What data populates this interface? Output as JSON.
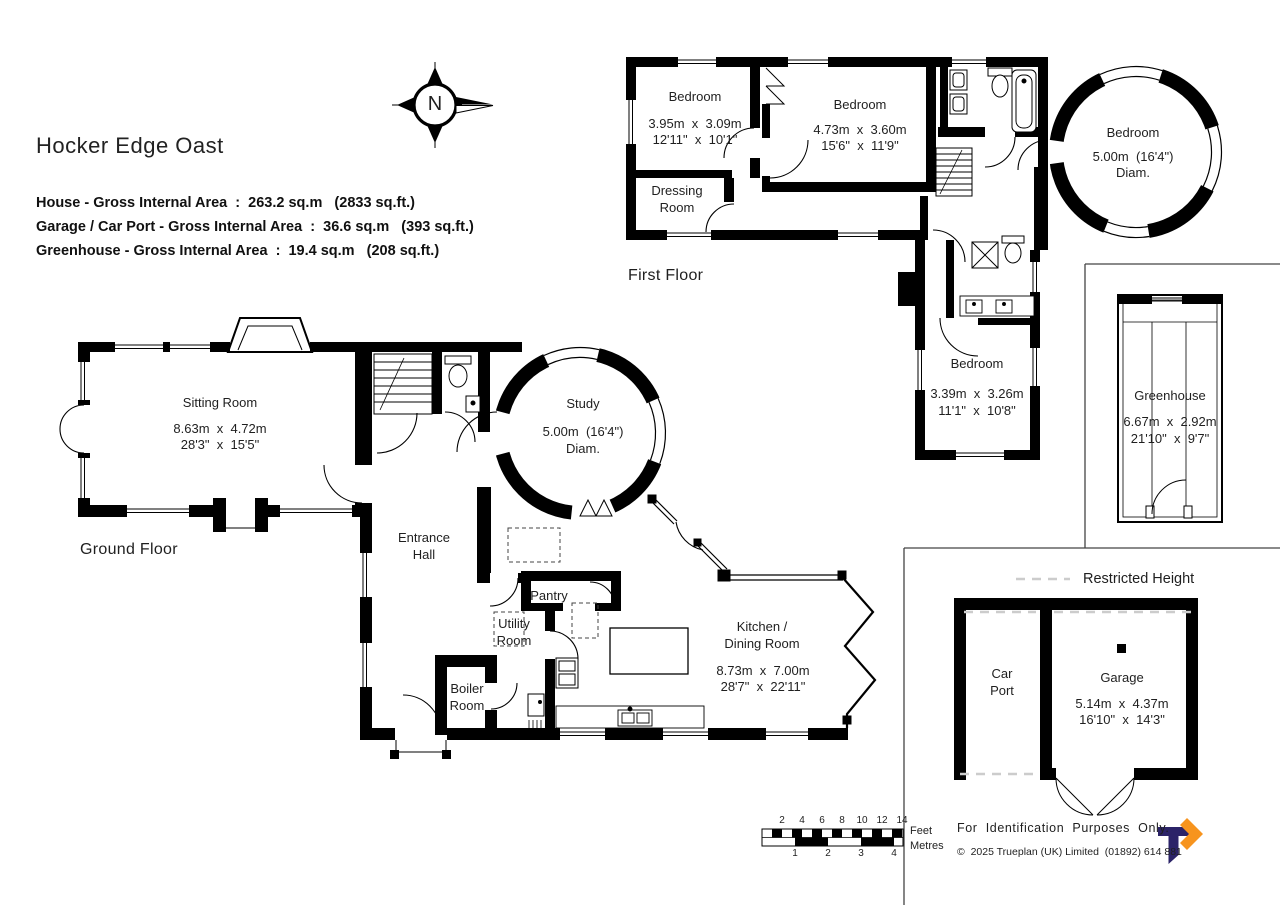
{
  "title": "Hocker Edge Oast",
  "areas": {
    "house": "House - Gross Internal Area  :  263.2 sq.m   (2833 sq.ft.)",
    "garage_car_port": "Garage / Car Port - Gross Internal Area  :  36.6 sq.m   (393 sq.ft.)",
    "greenhouse": "Greenhouse - Gross Internal Area  :  19.4 sq.m   (208 sq.ft.)"
  },
  "compass": {
    "north": "N"
  },
  "first_floor": {
    "label": "First Floor",
    "bedroom_left": {
      "name": "Bedroom",
      "metric": "3.95m  x  3.09m",
      "imperial": "12'11\"  x  10'1\""
    },
    "bedroom_middle": {
      "name": "Bedroom",
      "metric": "4.73m  x  3.60m",
      "imperial": "15'6\"  x  11'9\""
    },
    "dressing_room": {
      "name": "Dressing Room"
    },
    "bedroom_tower": {
      "name": "Bedroom",
      "metric": "5.00m  (16'4\")",
      "diam": "Diam."
    },
    "bedroom_rear": {
      "name": "Bedroom",
      "metric": "3.39m  x  3.26m",
      "imperial": "11'1\"  x  10'8\""
    }
  },
  "ground_floor": {
    "label": "Ground Floor",
    "sitting_room": {
      "name": "Sitting Room",
      "metric": "8.63m  x  4.72m",
      "imperial": "28'3\"  x  15'5\""
    },
    "entrance_hall": {
      "name": "Entrance Hall"
    },
    "study": {
      "name": "Study",
      "metric": "5.00m  (16'4\")",
      "diam": "Diam."
    },
    "pantry": {
      "name": "Pantry"
    },
    "utility_room": {
      "name": "Utility Room"
    },
    "boiler_room": {
      "name": "Boiler Room"
    },
    "kitchen_dining": {
      "name": "Kitchen / Dining Room",
      "metric": "8.73m  x  7.00m",
      "imperial": "28'7\"  x  22'11\""
    }
  },
  "outbuildings": {
    "greenhouse": {
      "name": "Greenhouse",
      "metric": "6.67m  x  2.92m",
      "imperial": "21'10\"  x  9'7\""
    },
    "car_port": {
      "name": "Car Port"
    },
    "garage": {
      "name": "Garage",
      "metric": "5.14m  x  4.37m",
      "imperial": "16'10\"  x  14'3\""
    }
  },
  "legend": {
    "restricted_height": "Restricted Height"
  },
  "scale_bar": {
    "feet": [
      "2",
      "4",
      "6",
      "8",
      "10",
      "12",
      "14"
    ],
    "metres": [
      "1",
      "2",
      "3",
      "4"
    ],
    "feet_label": "Feet",
    "metres_label": "Metres"
  },
  "footer": {
    "purpose": "For  Identification  Purposes  Only.",
    "copyright": "©  2025 Trueplan (UK) Limited  (01892) 614 881"
  },
  "colors": {
    "wall": "#000000",
    "logo_navy": "#2b2368",
    "logo_orange": "#f7941e",
    "restricted_dash": "#cccccc"
  }
}
